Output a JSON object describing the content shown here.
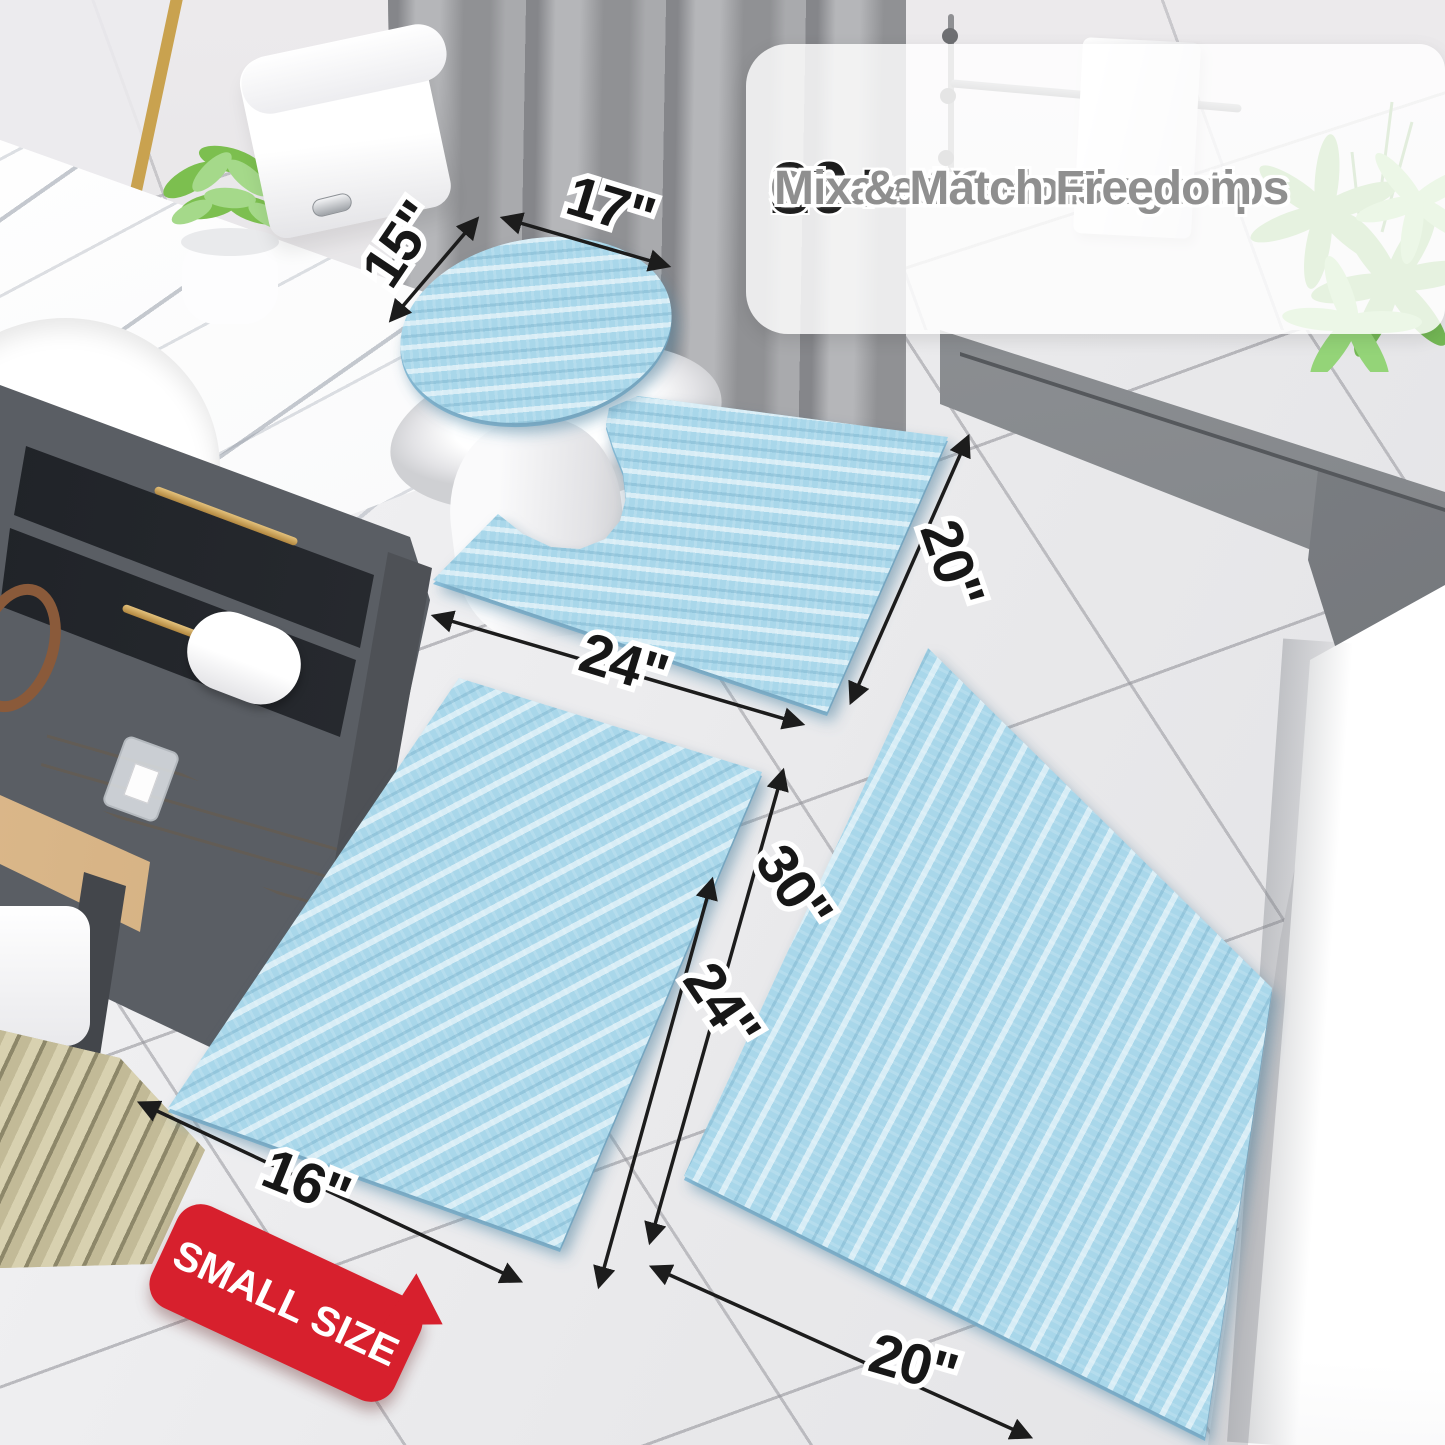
{
  "callout": {
    "items": [
      {
        "check": "✓",
        "number": "20+",
        "text": "Sizes at Your Fingertips"
      },
      {
        "check": "✓",
        "number": "30+",
        "text": "Curated Colors"
      },
      {
        "check": "✓",
        "number": "",
        "text": "Mix & Match Freedom"
      }
    ]
  },
  "dimensions": {
    "lid_depth": "15\"",
    "lid_width": "17\"",
    "contour_width": "24\"",
    "contour_depth": "20\"",
    "large_rug_length": "30\"",
    "small_rug_length": "24\"",
    "small_rug_width": "16\"",
    "large_rug_width": "20\""
  },
  "badge": {
    "label": "SMALL SIZE"
  },
  "colors": {
    "mat_blue": "#a9d7ea",
    "badge_red": "#d7202d",
    "annotation_black": "#1c1c1c",
    "callout_text_gray": "#8f8f8f"
  }
}
